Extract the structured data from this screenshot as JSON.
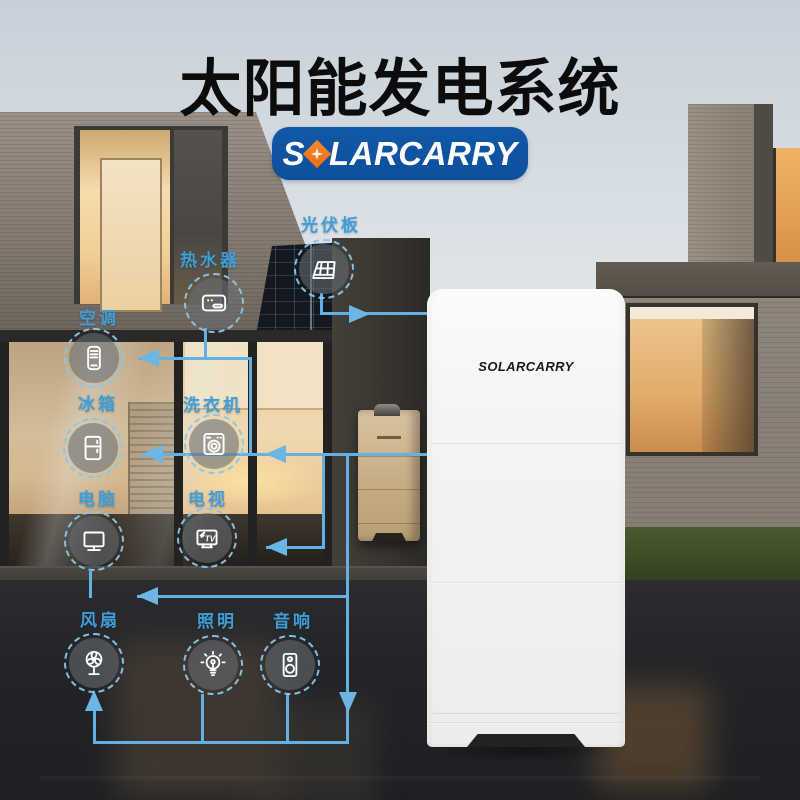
{
  "title": "太阳能发电系统",
  "brand": {
    "logo_prefix": "S",
    "logo_suffix": "LARCARRY",
    "logo_full": "SOLARCARRY"
  },
  "battery": {
    "brand_label": "SOLARCARRY"
  },
  "nodes": {
    "pv": {
      "label": "光伏板",
      "icon": "solar-panel-icon"
    },
    "water_heater": {
      "label": "热水器",
      "icon": "water-heater-icon"
    },
    "ac": {
      "label": "空调",
      "icon": "air-conditioner-icon"
    },
    "fridge": {
      "label": "冰箱",
      "icon": "fridge-icon"
    },
    "washer": {
      "label": "洗衣机",
      "icon": "washing-machine-icon"
    },
    "computer": {
      "label": "电脑",
      "icon": "computer-monitor-icon"
    },
    "tv": {
      "label": "电视",
      "icon": "tv-icon",
      "icon_text": "TV"
    },
    "fan": {
      "label": "风扇",
      "icon": "fan-icon"
    },
    "lighting": {
      "label": "照明",
      "icon": "light-bulb-icon"
    },
    "audio": {
      "label": "音响",
      "icon": "speaker-icon"
    }
  },
  "colors": {
    "label_blue": "#3f9ed8",
    "line_blue": "#63b1e3",
    "logo_blue": "#0f55a4",
    "logo_orange": "#f2731d",
    "title_black": "#0c0c0d"
  }
}
